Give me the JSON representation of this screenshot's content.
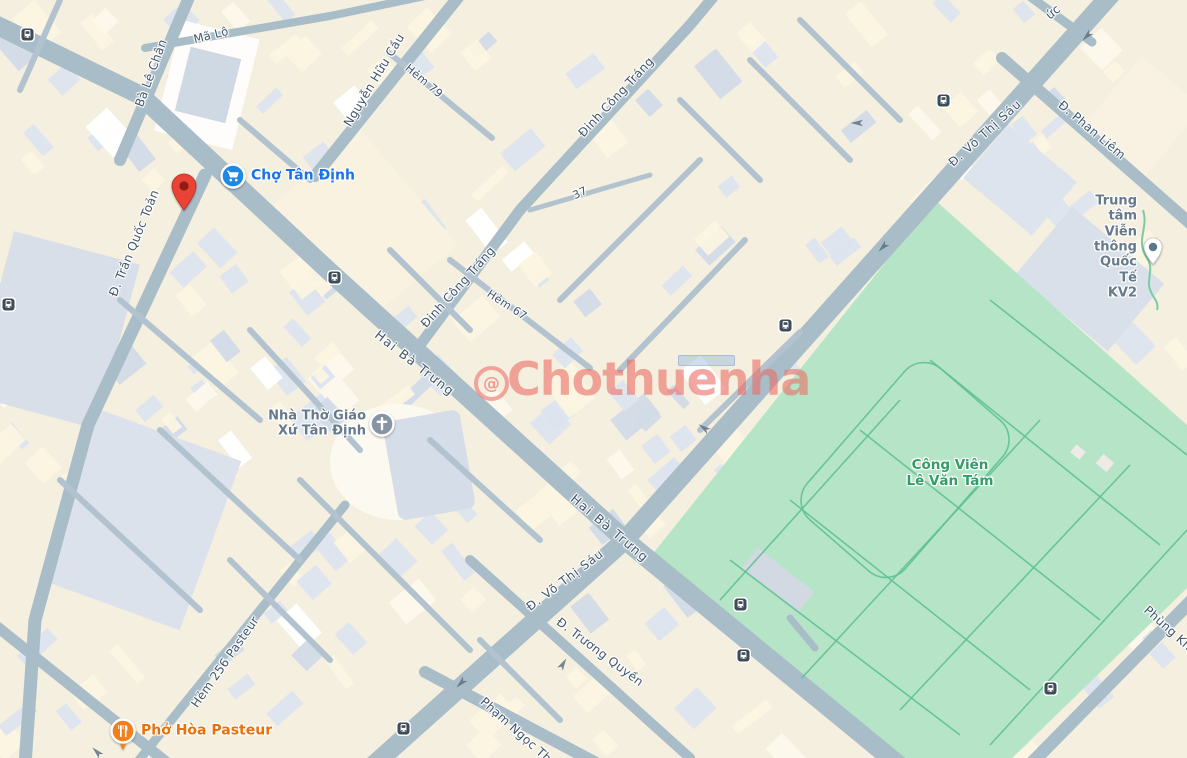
{
  "map": {
    "colors": {
      "background": "#f5efdf",
      "road": "#a9bdc9",
      "lane": "#b2c3cf",
      "park": "#b5e5c6",
      "park_path": "#5fc095",
      "street_text": "#40566b",
      "poi_blue": "#1a73e8",
      "poi_gray": "#667a8c",
      "poi_orange": "#e8710a",
      "park_text": "#2f9e68",
      "marker_red": "#ea4335",
      "bus_icon": "#3e4c57",
      "buildings": [
        "#dde4ee",
        "#d2dbe7",
        "#fbf4e2",
        "#fdf8ec",
        "#ffffff"
      ]
    },
    "street_labels": [
      {
        "text": "Mã Lộ",
        "x": 211,
        "y": 35,
        "rot": -14,
        "size": 11.5
      },
      {
        "text": "Bà Lê Chân",
        "x": 151,
        "y": 73,
        "rot": -70,
        "size": 12
      },
      {
        "text": "Nguyễn Hữu Cầu",
        "x": 374,
        "y": 80,
        "rot": -59,
        "size": 12
      },
      {
        "text": "Hẻm 79",
        "x": 424,
        "y": 81,
        "rot": 40,
        "size": 11
      },
      {
        "text": "Đinh Công Tráng",
        "x": 616,
        "y": 97,
        "rot": -47,
        "size": 12
      },
      {
        "text": "ức",
        "x": 1053,
        "y": 12,
        "rot": -40,
        "size": 12
      },
      {
        "text": "Đ. Võ Thị Sáu",
        "x": 985,
        "y": 133,
        "rot": -42,
        "size": 12,
        "ls": 1
      },
      {
        "text": "Đ. Phan Liêm",
        "x": 1092,
        "y": 130,
        "rot": 40,
        "size": 12
      },
      {
        "text": "Đ. Trần Quốc Toản",
        "x": 134,
        "y": 243,
        "rot": -68,
        "size": 12
      },
      {
        "text": "37",
        "x": 580,
        "y": 193,
        "rot": -25,
        "size": 11
      },
      {
        "text": "Đinh Công Tráng",
        "x": 458,
        "y": 287,
        "rot": -48,
        "size": 12
      },
      {
        "text": "Hẻm 67",
        "x": 507,
        "y": 305,
        "rot": 33,
        "size": 11
      },
      {
        "text": "Hai Bà Trưng",
        "x": 415,
        "y": 363,
        "rot": 38,
        "size": 12.5,
        "ls": 1.5
      },
      {
        "text": "Hai Bà Trưng",
        "x": 610,
        "y": 528,
        "rot": 40,
        "size": 12.5,
        "ls": 1.5
      },
      {
        "text": "Đ. Võ Thị Sáu",
        "x": 565,
        "y": 580,
        "rot": -37,
        "size": 12,
        "ls": 1
      },
      {
        "text": "Đ. Trương Quyền",
        "x": 600,
        "y": 652,
        "rot": 37,
        "size": 12
      },
      {
        "text": "Hẻm 256 Pasteur",
        "x": 225,
        "y": 662,
        "rot": -55,
        "size": 12
      },
      {
        "text": "Phạm Ngọc Th",
        "x": 516,
        "y": 730,
        "rot": 42,
        "size": 12
      },
      {
        "text": "Phùng Kh",
        "x": 1168,
        "y": 628,
        "rot": 42,
        "size": 12
      }
    ],
    "pois": [
      {
        "name": "cho-tan-dinh",
        "label": "Chợ Tân Định",
        "icon": "shopping-cart-icon",
        "icon_color": "#1e88e5",
        "text_color": "#1a73e8",
        "x": 233,
        "y": 176,
        "side": "right",
        "size": 14
      },
      {
        "name": "nha-tho-giao-xu-tan-dinh",
        "label": "Nhà Thờ Giáo\nXứ Tân Định",
        "icon": "church-cross-icon",
        "icon_color": "#8794a3",
        "text_color": "#667a8c",
        "x": 382,
        "y": 424,
        "side": "left",
        "size": 13
      },
      {
        "name": "trung-tam-vien-thong-quoc-te-kv2",
        "label": "Trung tâm Viễn\nthông Quốc Tế KV2",
        "icon": "place-pin-icon",
        "icon_color": "#5d7689",
        "text_color": "#667a8c",
        "x": 1153,
        "y": 247,
        "side": "left",
        "size": 13
      },
      {
        "name": "cong-vien-le-van-tam",
        "label": "Công Viên\nLê Văn Tám",
        "icon": "",
        "icon_color": "",
        "text_color": "#2f9e68",
        "x": 950,
        "y": 474,
        "side": "center",
        "size": 13.5
      },
      {
        "name": "pho-hoa-pasteur",
        "label": "Phở Hòa Pasteur",
        "icon": "restaurant-icon",
        "icon_color": "#f07f1d",
        "text_color": "#e8710a",
        "x": 123,
        "y": 731,
        "side": "right",
        "size": 14
      }
    ],
    "marker": {
      "x": 184,
      "y": 210,
      "color": "#ea4335"
    },
    "bus_stops": [
      [
        27,
        34
      ],
      [
        8,
        304
      ],
      [
        334,
        277
      ],
      [
        943,
        100
      ],
      [
        785,
        325
      ],
      [
        740,
        604
      ],
      [
        743,
        655
      ],
      [
        403,
        728
      ],
      [
        1050,
        688
      ]
    ],
    "arrows": [
      {
        "x": 1087,
        "y": 36,
        "rot": 135
      },
      {
        "x": 857,
        "y": 123,
        "rot": 180
      },
      {
        "x": 883,
        "y": 247,
        "rot": 135
      },
      {
        "x": 704,
        "y": 428,
        "rot": 215
      },
      {
        "x": 461,
        "y": 683,
        "rot": 135
      },
      {
        "x": 97,
        "y": 752,
        "rot": 225
      },
      {
        "x": 563,
        "y": 664,
        "rot": 300
      }
    ]
  },
  "watermark": {
    "text": "Chothuenha",
    "logo_glyph": "@",
    "color": "#ec746e"
  }
}
